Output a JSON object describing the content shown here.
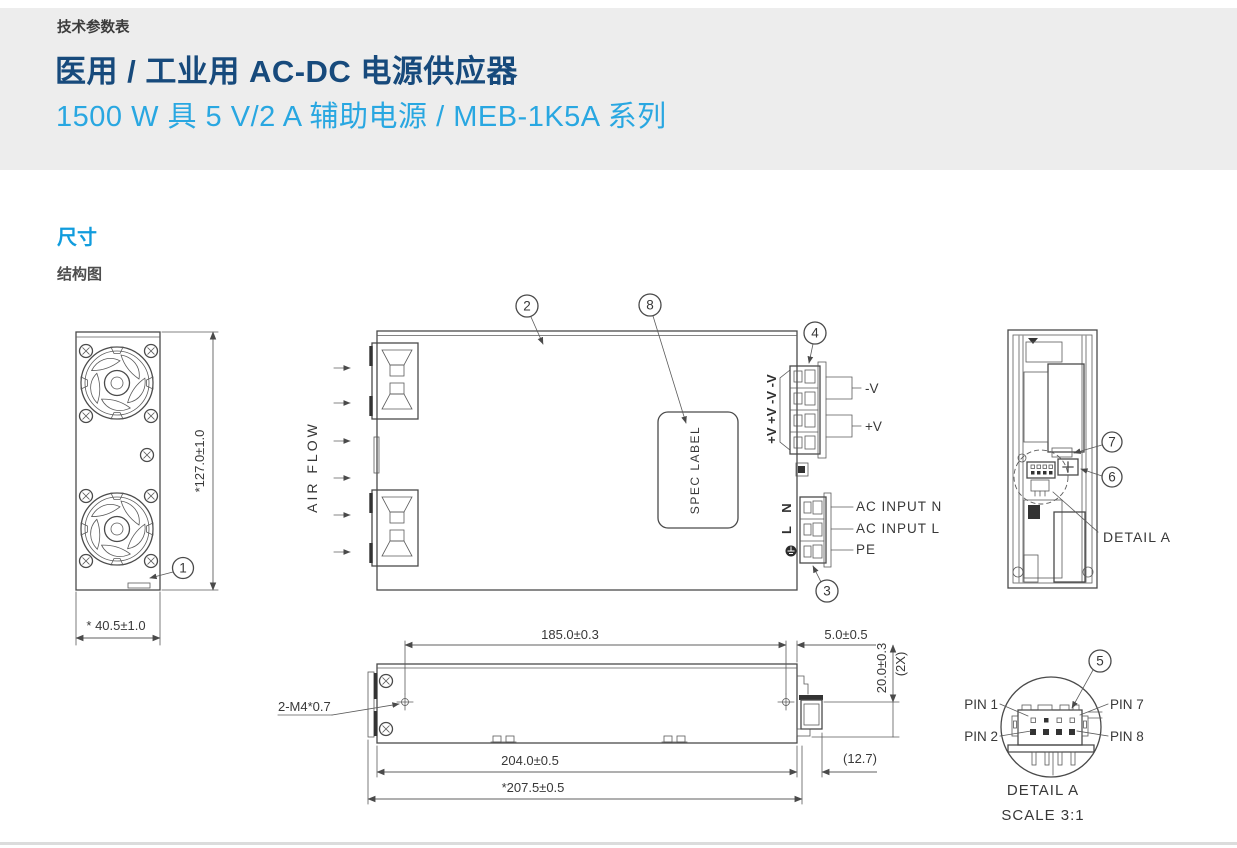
{
  "page": {
    "eyebrow": "技术参数表",
    "title": "医用 / 工业用 AC-DC 电源供应器",
    "subtitle": "1500 W 具 5 V/2 A 辅助电源 / MEB-1K5A 系列",
    "section_heading": "尺寸",
    "sub_heading": "结构图"
  },
  "colors": {
    "header_band": "#ededed",
    "title_navy": "#174a7c",
    "subtitle_blue": "#29a7e1",
    "section_blue": "#119cdd",
    "line_gray": "#4a4a4a"
  },
  "drawing": {
    "callouts": {
      "c1": "1",
      "c2": "2",
      "c3": "3",
      "c4": "4",
      "c5": "5",
      "c6": "6",
      "c7": "7",
      "c8": "8"
    },
    "front": {
      "dim_height": "*127.0±1.0",
      "dim_width": "* 40.5±1.0"
    },
    "top": {
      "air_flow": "AIR FLOW",
      "spec_label": "SPEC LABEL",
      "dc_labels": "+V +V -V -V",
      "neg": "-V",
      "pos": "+V",
      "n": "N",
      "l": "L",
      "ac_n": "AC INPUT N",
      "ac_l": "AC INPUT L",
      "pe": "PE"
    },
    "side": {
      "d185": "185.0±0.3",
      "d5": "5.0±0.5",
      "d20": "20.0±0.3",
      "d20x": "(2X)",
      "d204": "204.0±0.5",
      "d2075": "*207.5±0.5",
      "d127": "(12.7)",
      "screws": "2-M4*0.7"
    },
    "end": {
      "detail": "DETAIL A"
    },
    "detail": {
      "pin1": "PIN 1",
      "pin2": "PIN 2",
      "pin7": "PIN 7",
      "pin8": "PIN 8",
      "title": "DETAIL A",
      "scale": "SCALE 3:1"
    }
  }
}
